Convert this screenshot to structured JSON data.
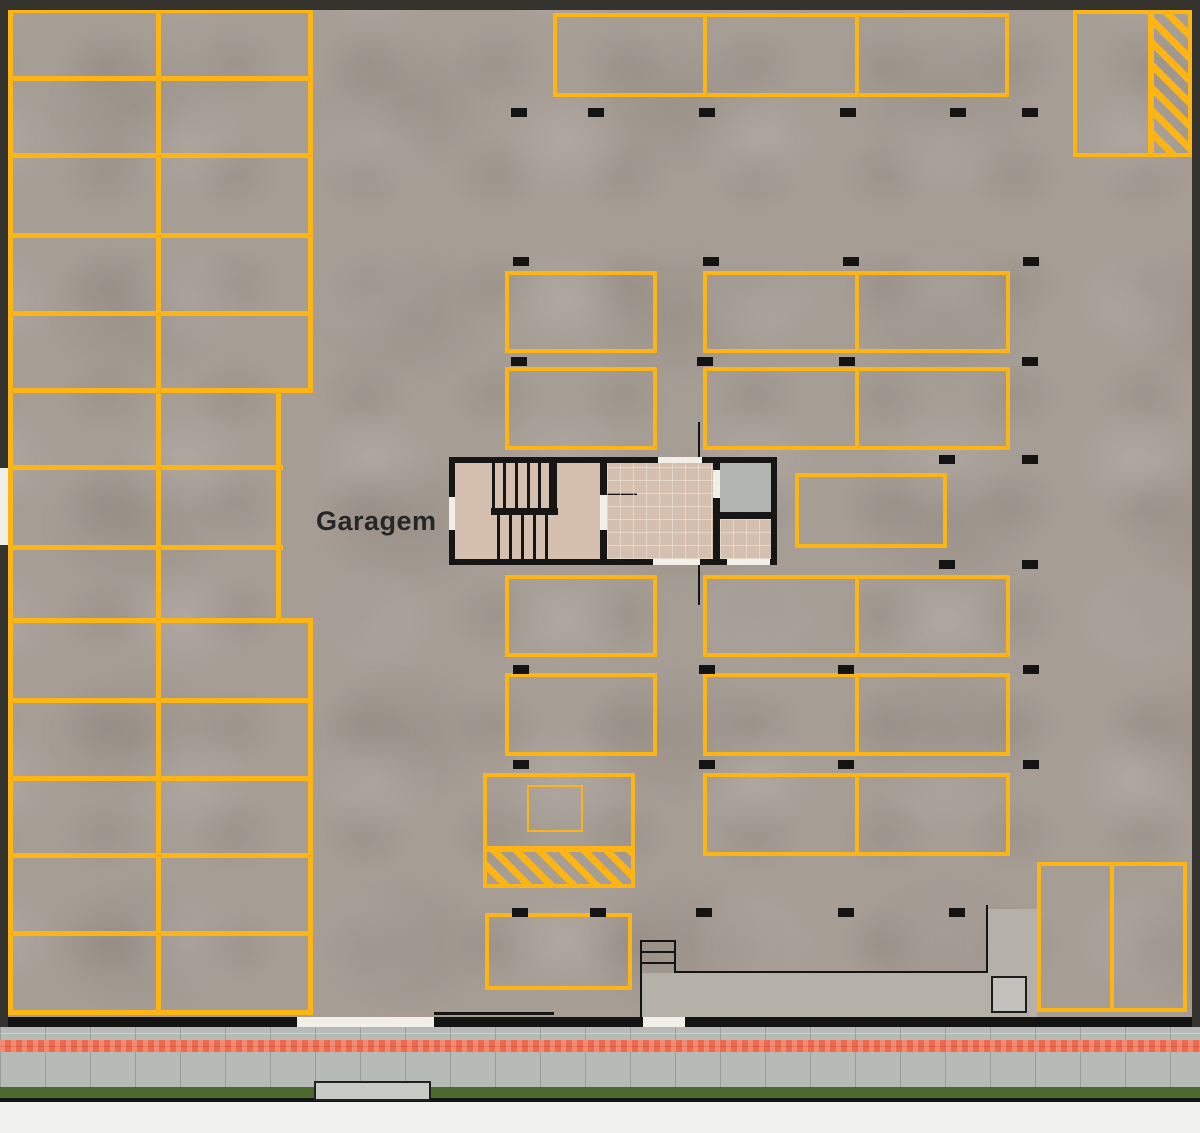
{
  "labels": {
    "garagem": "Garagem"
  },
  "colors": {
    "parking_line_yellow": "#fdb515",
    "floor_concrete": "#a69d95",
    "wall_black": "#141414",
    "outer_border": "#34332e",
    "core_floor_tan": "#d5bfae",
    "elevator_gray": "#b3b5b1",
    "ramp_gray": "#b5b0a8",
    "sidewalk_gray": "#b7bbb7",
    "curb_stripe_red": "#ed6a4c",
    "grass_green": "#4c6a2d",
    "page_background": "#f1f1ef"
  },
  "plan": {
    "left_block_lines": {
      "horizontal": [
        [
          8,
          8,
          305,
          5
        ],
        [
          8,
          76,
          305,
          5
        ],
        [
          8,
          153,
          305,
          5
        ],
        [
          8,
          233,
          305,
          5
        ],
        [
          8,
          311,
          305,
          5
        ],
        [
          8,
          388,
          305,
          5
        ],
        [
          8,
          465,
          275,
          5
        ],
        [
          8,
          545,
          275,
          5
        ],
        [
          8,
          618,
          305,
          5
        ],
        [
          8,
          698,
          305,
          5
        ],
        [
          8,
          776,
          305,
          5
        ],
        [
          8,
          853,
          305,
          5
        ],
        [
          8,
          931,
          305,
          5
        ],
        [
          8,
          1010,
          305,
          5
        ]
      ],
      "vertical": [
        [
          8,
          8,
          5,
          1007
        ],
        [
          156,
          8,
          5,
          1007
        ],
        [
          308,
          8,
          5,
          385
        ],
        [
          276,
          388,
          5,
          235
        ],
        [
          308,
          618,
          5,
          397
        ]
      ]
    },
    "space_boxes": [
      [
        553,
        13,
        456,
        84
      ],
      [
        1073,
        10,
        119,
        147
      ],
      [
        505,
        271,
        152,
        82
      ],
      [
        703,
        271,
        307,
        82
      ],
      [
        505,
        367,
        152,
        83
      ],
      [
        703,
        367,
        307,
        83
      ],
      [
        795,
        473,
        152,
        75
      ],
      [
        505,
        575,
        152,
        82
      ],
      [
        703,
        575,
        307,
        82
      ],
      [
        505,
        673,
        152,
        83
      ],
      [
        703,
        673,
        307,
        83
      ],
      [
        483,
        773,
        152,
        77
      ],
      [
        703,
        773,
        307,
        83
      ],
      [
        485,
        913,
        147,
        77
      ],
      [
        1037,
        862,
        150,
        150
      ]
    ],
    "space_dividers": [
      [
        703,
        13,
        4,
        84
      ],
      [
        855,
        13,
        4,
        84
      ],
      [
        1148,
        10,
        4,
        147
      ],
      [
        855,
        271,
        4,
        82
      ],
      [
        855,
        367,
        4,
        83
      ],
      [
        855,
        575,
        4,
        82
      ],
      [
        855,
        673,
        4,
        83
      ],
      [
        855,
        773,
        4,
        83
      ],
      [
        1110,
        862,
        4,
        150
      ]
    ],
    "moto_inner_box": [
      527,
      785,
      56,
      47
    ],
    "hatch_boxes": [
      [
        483,
        848,
        152,
        40
      ],
      [
        1150,
        10,
        42,
        147
      ]
    ],
    "markers": [
      [
        511,
        108
      ],
      [
        588,
        108
      ],
      [
        699,
        108
      ],
      [
        840,
        108
      ],
      [
        950,
        108
      ],
      [
        1022,
        108
      ],
      [
        513,
        257
      ],
      [
        703,
        257
      ],
      [
        843,
        257
      ],
      [
        1023,
        257
      ],
      [
        511,
        357
      ],
      [
        697,
        357
      ],
      [
        839,
        357
      ],
      [
        1022,
        357
      ],
      [
        939,
        455
      ],
      [
        1022,
        455
      ],
      [
        939,
        560
      ],
      [
        1022,
        560
      ],
      [
        513,
        665
      ],
      [
        699,
        665
      ],
      [
        838,
        665
      ],
      [
        1023,
        665
      ],
      [
        513,
        760
      ],
      [
        699,
        760
      ],
      [
        838,
        760
      ],
      [
        1023,
        760
      ],
      [
        512,
        908
      ],
      [
        590,
        908
      ],
      [
        696,
        908
      ],
      [
        838,
        908
      ],
      [
        949,
        908
      ]
    ],
    "ramp_areas": [
      [
        988,
        909,
        49,
        108
      ],
      [
        640,
        973,
        348,
        44
      ]
    ],
    "detail_lines": [
      [
        986,
        905,
        2,
        68
      ],
      [
        675,
        971,
        313,
        2
      ],
      [
        640,
        940,
        36,
        2
      ],
      [
        640,
        951,
        36,
        2
      ],
      [
        640,
        962,
        36,
        2
      ],
      [
        640,
        940,
        2,
        77
      ],
      [
        674,
        940,
        2,
        33
      ],
      [
        434,
        1012,
        120,
        3
      ],
      [
        698,
        422,
        2,
        35
      ],
      [
        698,
        565,
        2,
        40
      ]
    ],
    "ramp_landing_box": [
      991,
      976,
      36,
      37
    ],
    "wall_openings": [
      [
        658,
        457,
        44,
        6
      ],
      [
        653,
        559,
        47,
        6
      ],
      [
        727,
        559,
        43,
        6
      ],
      [
        449,
        497,
        6,
        33
      ],
      [
        0,
        468,
        8,
        77
      ],
      [
        297,
        1017,
        137,
        10
      ],
      [
        643,
        1017,
        42,
        10
      ]
    ]
  }
}
